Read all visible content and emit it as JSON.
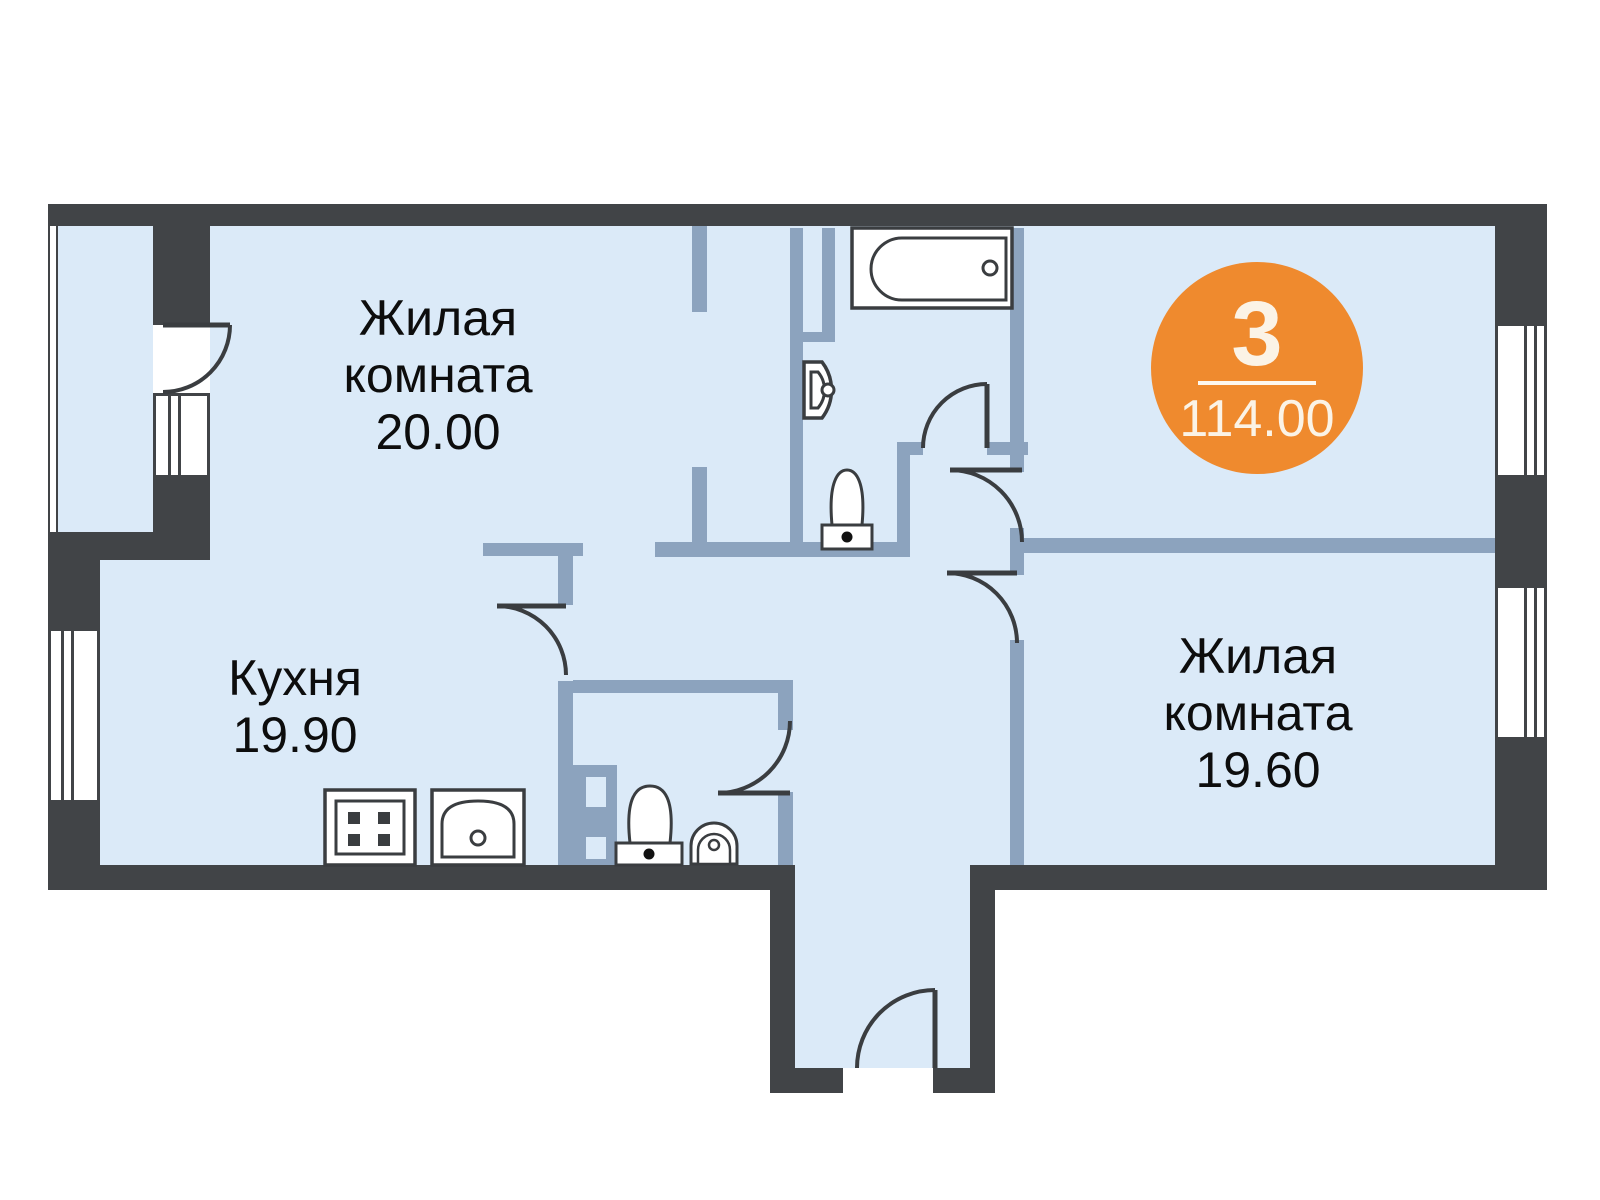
{
  "plan": {
    "title": "apartment-floor-plan",
    "badge": {
      "rooms": "3",
      "area": "114.00"
    },
    "rooms": [
      {
        "id": "living-room-1",
        "name": "Жилая комната",
        "area": "20.00"
      },
      {
        "id": "kitchen",
        "name": "Кухня",
        "area": "19.90"
      },
      {
        "id": "living-room-2",
        "name": "Жилая комната",
        "area": "19.60"
      }
    ],
    "fixtures": [
      "bathtub",
      "wall-sink",
      "toilet-bathroom",
      "toilet-wc",
      "washbasin-wc",
      "stove",
      "kitchen-sink"
    ],
    "colors": {
      "outer_wall": "#414447",
      "partition": "#8ca3be",
      "floor": "#dbeaf8",
      "badge": "#ef8a2e",
      "badge_text": "#fbf3e6",
      "fixture_line": "#3a3d40"
    }
  }
}
